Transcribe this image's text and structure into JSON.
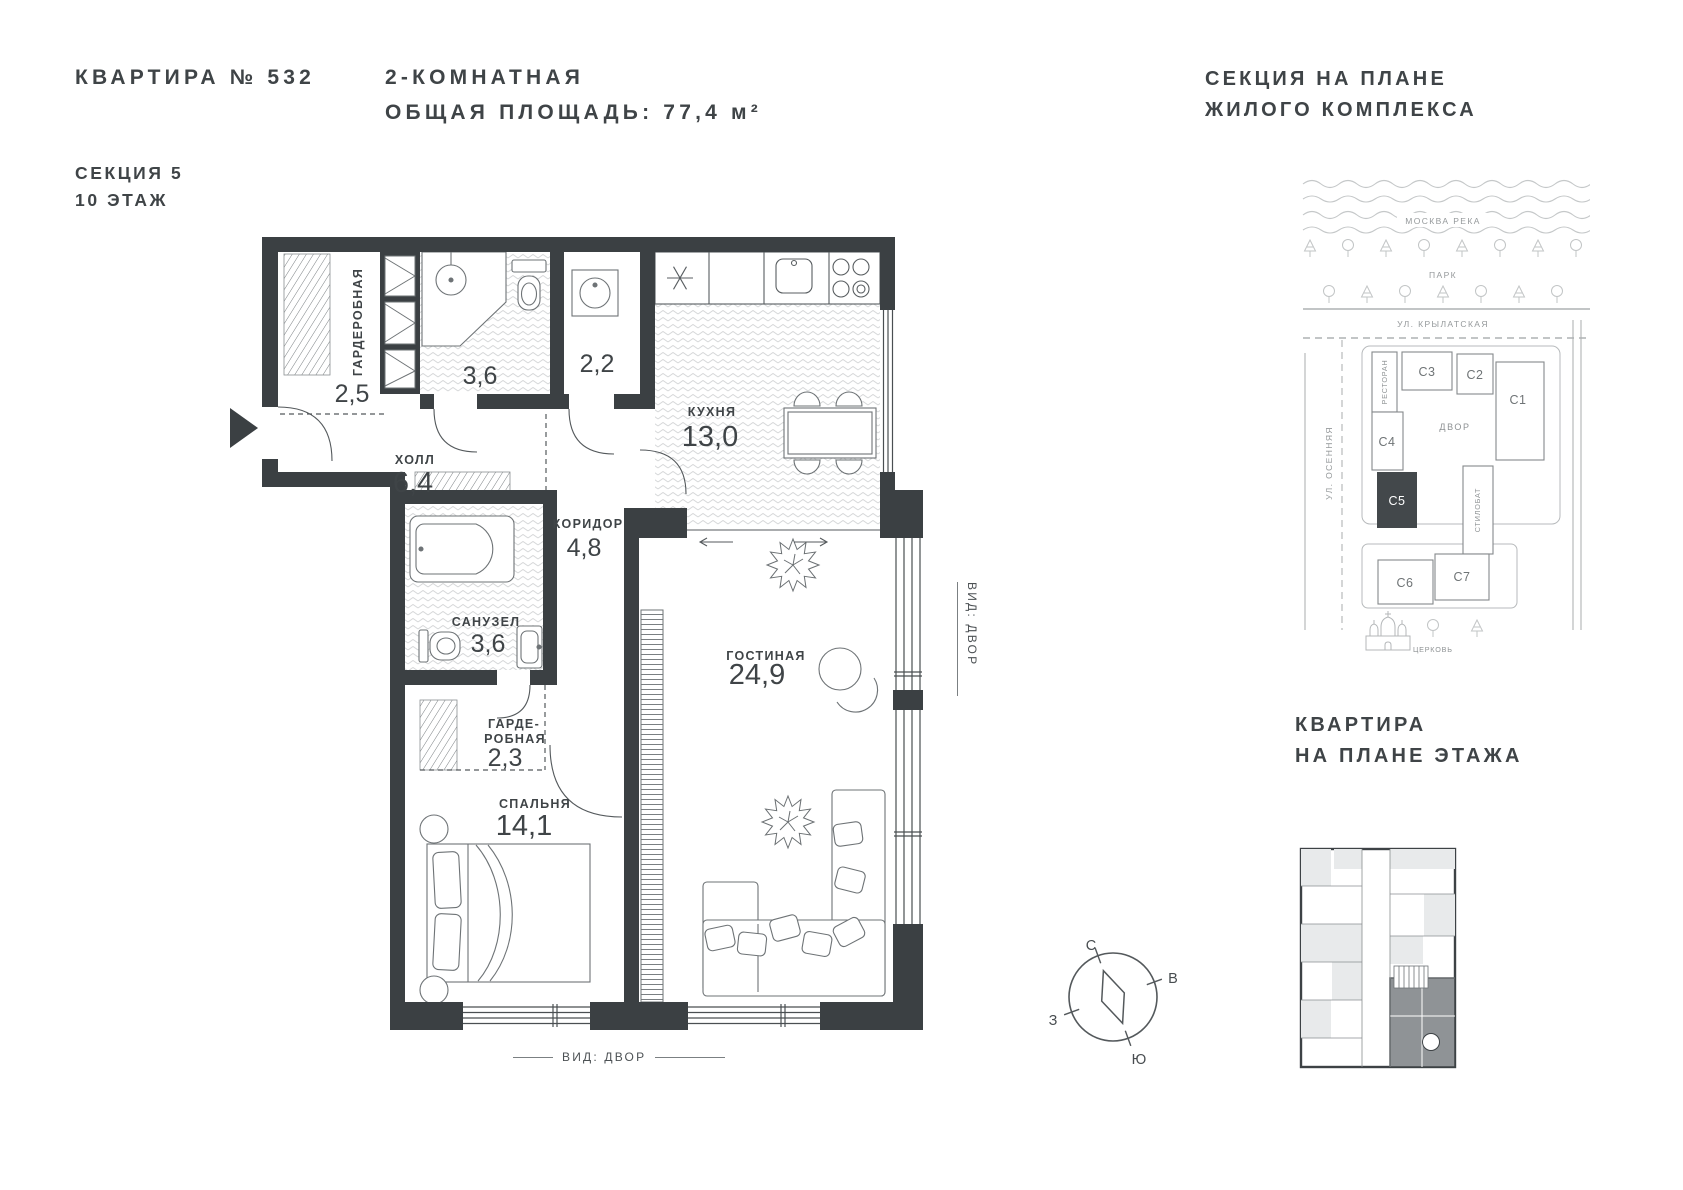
{
  "header": {
    "apartment_title": "КВАРТИРА № 532",
    "section": "СЕКЦИЯ 5",
    "floor": "10 ЭТАЖ",
    "rooms_type": "2-КОМНАТНАЯ",
    "total_area": "ОБЩАЯ ПЛОЩАДЬ: 77,4 м²"
  },
  "site_map": {
    "title_line1": "СЕКЦИЯ НА ПЛАНЕ",
    "title_line2": "ЖИЛОГО КОМПЛЕКСА",
    "river_label": "МОСКВА РЕКА",
    "park_label": "ПАРК",
    "street_top_label": "УЛ. КРЫЛАТСКАЯ",
    "street_left_label": "УЛ. ОСЕННЯЯ",
    "courtyard_label": "ДВОР",
    "restaurant_label": "РЕСТОРАН",
    "stylobate_label": "СТИЛОБАТ",
    "church_label": "ЦЕРКОВЬ",
    "sections": [
      {
        "id": "С1"
      },
      {
        "id": "С2"
      },
      {
        "id": "С3"
      },
      {
        "id": "С4"
      },
      {
        "id": "С5",
        "active": true
      },
      {
        "id": "С6"
      },
      {
        "id": "С7"
      }
    ],
    "active_section": "С5"
  },
  "floor_plan": {
    "rooms": [
      {
        "name": "ГАРДЕРОБНАЯ",
        "area": "2,5"
      },
      {
        "name": "",
        "area": "3,6"
      },
      {
        "name": "",
        "area": "2,2"
      },
      {
        "name": "КУХНЯ",
        "area": "13,0"
      },
      {
        "name": "ХОЛЛ",
        "area": "6,4"
      },
      {
        "name": "КОРИДОР",
        "area": "4,8"
      },
      {
        "name": "САНУЗЕЛ",
        "area": "3,6"
      },
      {
        "name_line1": "ГАРДЕ-",
        "name_line2": "РОБНАЯ",
        "area": "2,3"
      },
      {
        "name": "СПАЛЬНЯ",
        "area": "14,1"
      },
      {
        "name": "ГОСТИНАЯ",
        "area": "24,9"
      }
    ],
    "view_label_bottom": "ВИД: ДВОР",
    "view_label_right": "ВИД: ДВОР"
  },
  "compass": {
    "north": "С",
    "east": "В",
    "west": "З",
    "south": "Ю"
  },
  "thumbnail": {
    "title_line1": "КВАРТИРА",
    "title_line2": "НА ПЛАНЕ ЭТАЖА"
  },
  "colors": {
    "wall": "#3b4043",
    "text_dark": "#3f4447",
    "map_gray": "#95999b",
    "active_fill": "#43484b",
    "highlight_unit": "#8f9396"
  }
}
